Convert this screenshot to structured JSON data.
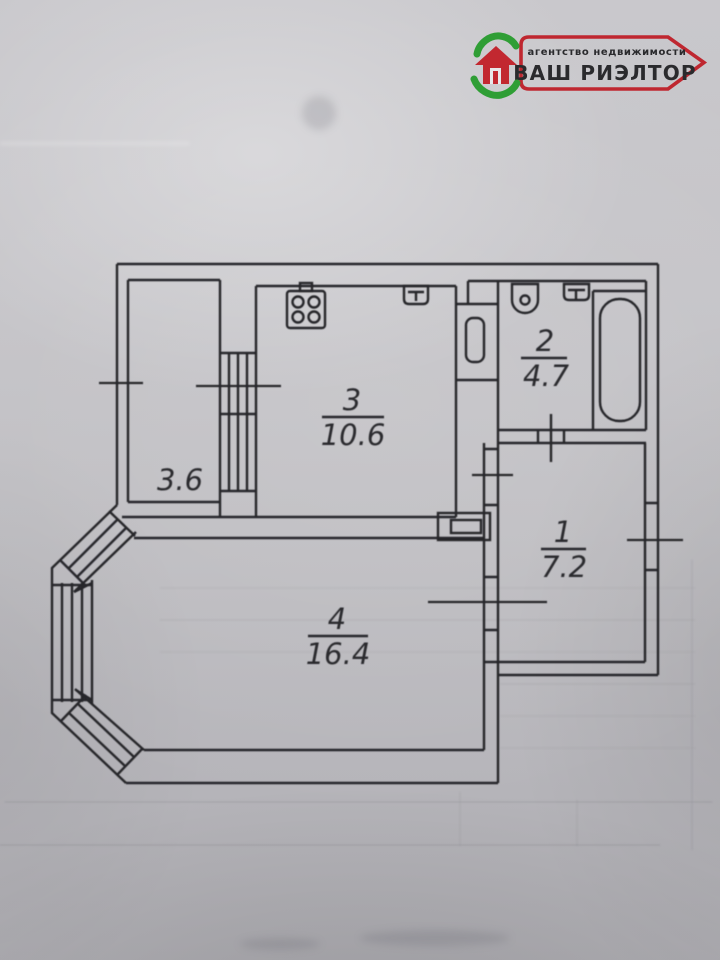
{
  "logo": {
    "tagline": "агентство недвижимости",
    "brand": "ВАШ РИЭЛТОР",
    "red": "#c2262e",
    "green": "#2f9e35",
    "icon": "house-in-hands-icon"
  },
  "floor_plan": {
    "rooms": [
      {
        "number": "3",
        "area": "10.6"
      },
      {
        "number": "2",
        "area": "4.7"
      },
      {
        "number": "1",
        "area": "7.2"
      },
      {
        "number": "4",
        "area": "16.4"
      }
    ],
    "balcony": {
      "area": "3.6"
    },
    "icons": [
      "stove-icon",
      "kitchen-sink-icon",
      "toilet-icon",
      "wash-sink-icon",
      "bathtub-icon",
      "bay-window",
      "vent-duct-icon"
    ]
  }
}
